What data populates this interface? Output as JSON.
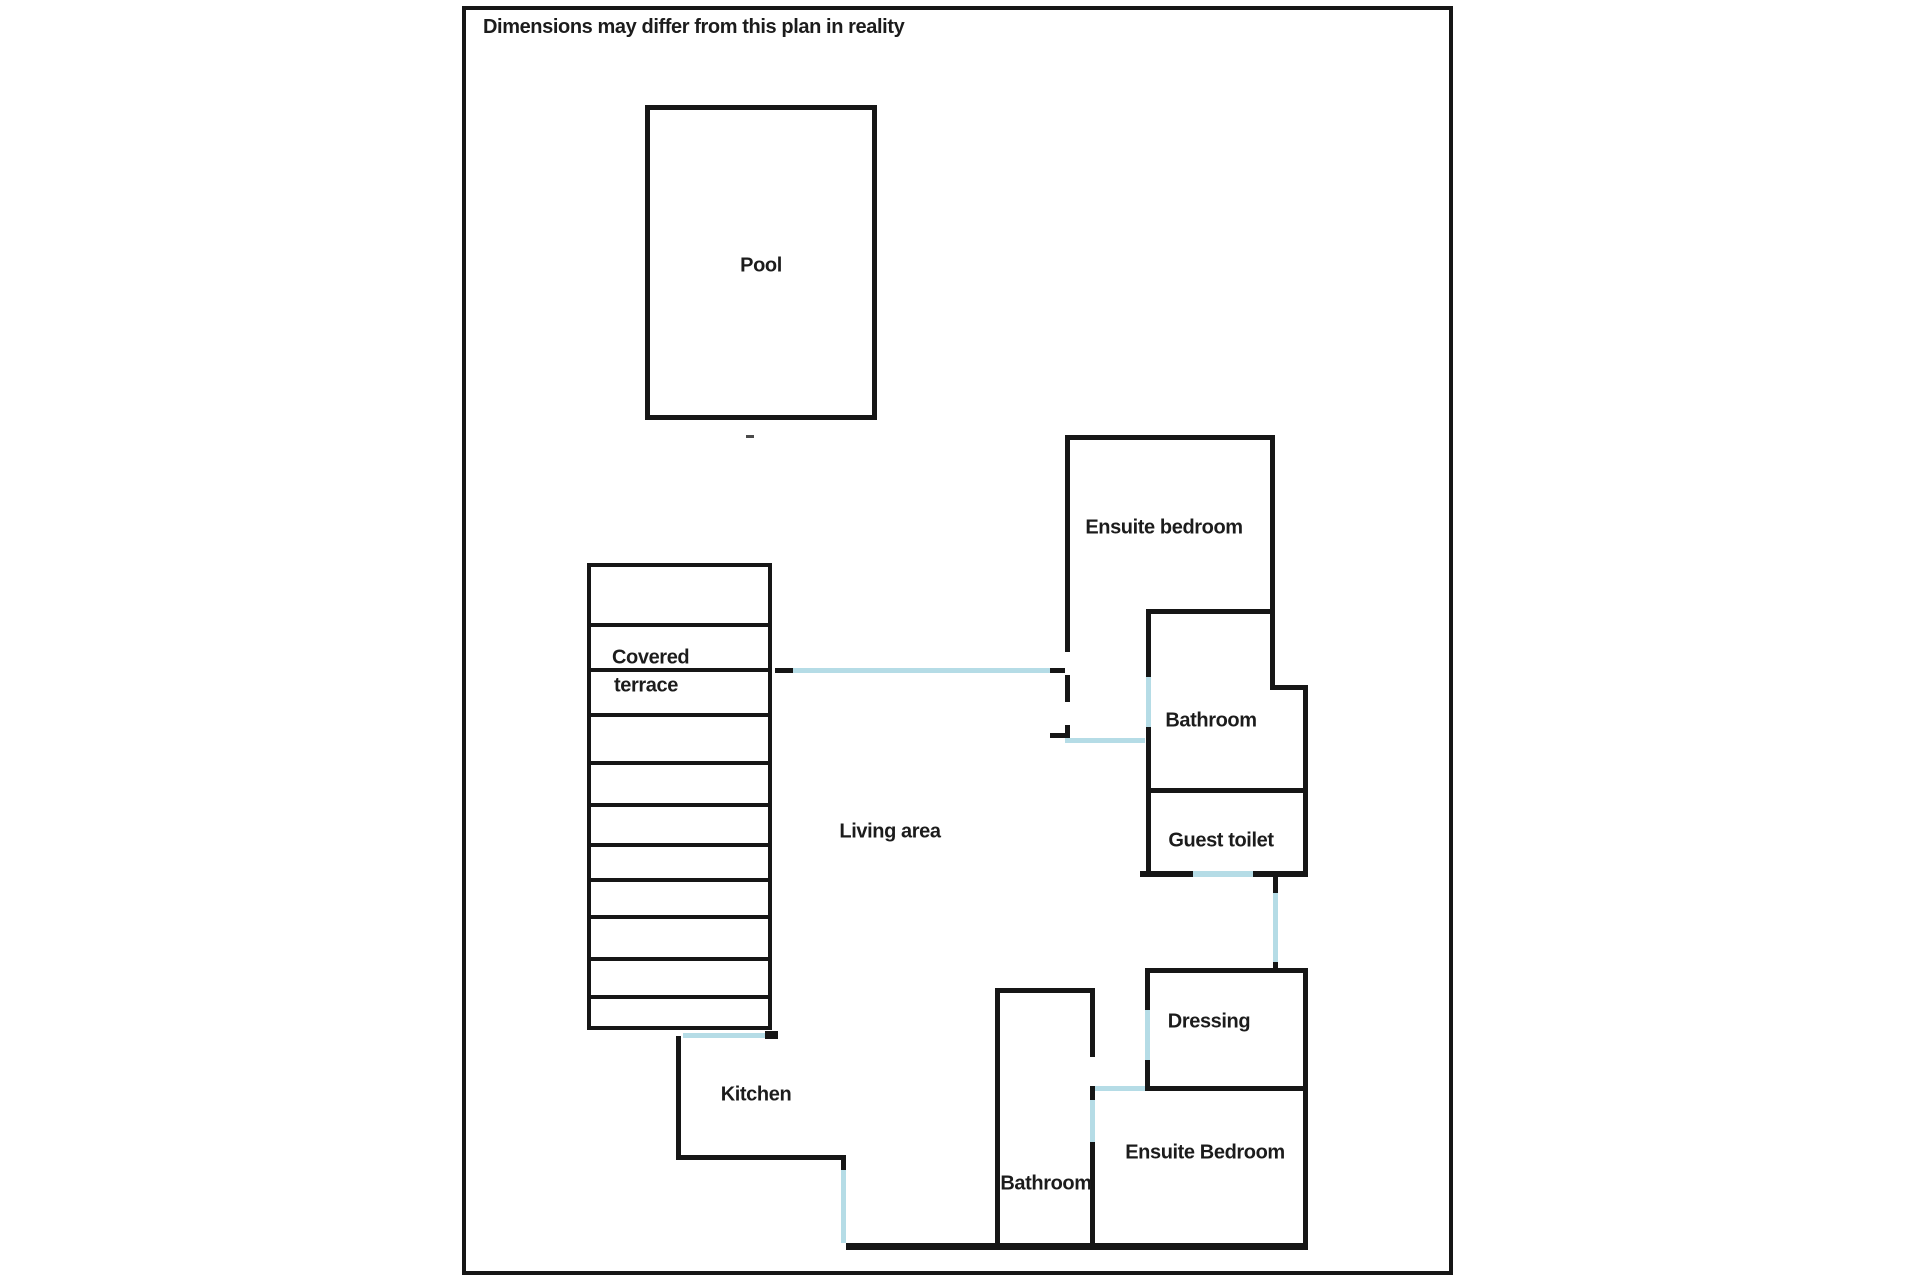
{
  "disclaimer": "Dimensions may differ from this plan in reality",
  "colors": {
    "wall": "#161616",
    "door": "#b5dce6",
    "background": "#ffffff",
    "text": "#1c1c1c",
    "mark": "#4a4a4a"
  },
  "rooms": {
    "pool": {
      "label": "Pool"
    },
    "covered_terrace": {
      "label_line1": "Covered",
      "label_line2": "terrace"
    },
    "living_area": {
      "label": "Living area"
    },
    "ensuite_bedroom_top": {
      "label": "Ensuite bedroom"
    },
    "bathroom_top": {
      "label": "Bathroom"
    },
    "guest_toilet": {
      "label": "Guest toilet"
    },
    "dressing": {
      "label": "Dressing"
    },
    "ensuite_bedroom_bottom": {
      "label": "Ensuite Bedroom"
    },
    "bathroom_bottom": {
      "label": "Bathroom"
    },
    "kitchen": {
      "label": "Kitchen"
    }
  },
  "floorplan": {
    "outlines": [
      {
        "name": "plan-outer-border",
        "x": 462,
        "y": 6,
        "w": 991,
        "h": 1269,
        "stroke": 4
      },
      {
        "name": "pool-outline",
        "x": 645,
        "y": 105,
        "w": 232,
        "h": 315,
        "stroke": 5
      },
      {
        "name": "terrace-outline",
        "x": 587,
        "y": 563,
        "w": 185,
        "h": 467,
        "stroke": 4
      }
    ],
    "walls": [
      {
        "name": "terrace-slat",
        "x": 587,
        "y": 623,
        "w": 185,
        "h": 4
      },
      {
        "name": "terrace-slat",
        "x": 587,
        "y": 668,
        "w": 185,
        "h": 4
      },
      {
        "name": "terrace-slat",
        "x": 587,
        "y": 713,
        "w": 185,
        "h": 4
      },
      {
        "name": "terrace-slat",
        "x": 587,
        "y": 761,
        "w": 185,
        "h": 4
      },
      {
        "name": "terrace-slat",
        "x": 587,
        "y": 803,
        "w": 185,
        "h": 4
      },
      {
        "name": "terrace-slat",
        "x": 587,
        "y": 843,
        "w": 185,
        "h": 4
      },
      {
        "name": "terrace-slat",
        "x": 587,
        "y": 878,
        "w": 185,
        "h": 4
      },
      {
        "name": "terrace-slat",
        "x": 587,
        "y": 915,
        "w": 185,
        "h": 4
      },
      {
        "name": "terrace-slat",
        "x": 587,
        "y": 957,
        "w": 185,
        "h": 4
      },
      {
        "name": "terrace-slat",
        "x": 587,
        "y": 995,
        "w": 185,
        "h": 4
      },
      {
        "name": "living-door-tick-left",
        "x": 775,
        "y": 668,
        "w": 18,
        "h": 5
      },
      {
        "name": "living-door-tick-right",
        "x": 1050,
        "y": 668,
        "w": 15,
        "h": 5
      },
      {
        "name": "ensuite-top-wall-top",
        "x": 1065,
        "y": 435,
        "w": 210,
        "h": 5
      },
      {
        "name": "ensuite-top-wall-left",
        "x": 1065,
        "y": 435,
        "w": 5,
        "h": 217
      },
      {
        "name": "ensuite-top-wall-left",
        "x": 1065,
        "y": 675,
        "w": 5,
        "h": 27
      },
      {
        "name": "ensuite-top-wall-left",
        "x": 1065,
        "y": 725,
        "w": 5,
        "h": 15
      },
      {
        "name": "ensuite-top-wall-tick",
        "x": 1050,
        "y": 733,
        "w": 15,
        "h": 5
      },
      {
        "name": "ensuite-top-wall-right",
        "x": 1270,
        "y": 435,
        "w": 5,
        "h": 255
      },
      {
        "name": "bathroom-top-wall-top",
        "x": 1147,
        "y": 609,
        "w": 128,
        "h": 5
      },
      {
        "name": "bathroom-top-jog",
        "x": 1270,
        "y": 685,
        "w": 38,
        "h": 5
      },
      {
        "name": "right-wing-wall-right",
        "x": 1303,
        "y": 685,
        "w": 5,
        "h": 191
      },
      {
        "name": "bathroom-top-wall-left",
        "x": 1146,
        "y": 609,
        "w": 5,
        "h": 68
      },
      {
        "name": "bathroom-top-wall-left",
        "x": 1146,
        "y": 727,
        "w": 5,
        "h": 64
      },
      {
        "name": "bathroom-top-wall-bottom",
        "x": 1146,
        "y": 788,
        "w": 162,
        "h": 5
      },
      {
        "name": "guest-toilet-wall-left",
        "x": 1146,
        "y": 788,
        "w": 5,
        "h": 88
      },
      {
        "name": "guest-toilet-wall-bottom",
        "x": 1140,
        "y": 871,
        "w": 53,
        "h": 6
      },
      {
        "name": "guest-toilet-wall-bottom",
        "x": 1253,
        "y": 871,
        "w": 55,
        "h": 6
      },
      {
        "name": "hall-connector-tick",
        "x": 1273,
        "y": 876,
        "w": 5,
        "h": 17
      },
      {
        "name": "hall-connector-tick",
        "x": 1273,
        "y": 962,
        "w": 5,
        "h": 8
      },
      {
        "name": "dressing-wall-top",
        "x": 1145,
        "y": 968,
        "w": 163,
        "h": 5
      },
      {
        "name": "dressing-wall-left",
        "x": 1145,
        "y": 968,
        "w": 5,
        "h": 42
      },
      {
        "name": "dressing-wall-left",
        "x": 1145,
        "y": 1060,
        "w": 5,
        "h": 26
      },
      {
        "name": "dressing-wall-bottom",
        "x": 1145,
        "y": 1086,
        "w": 163,
        "h": 5
      },
      {
        "name": "right-wing-wall-right",
        "x": 1303,
        "y": 968,
        "w": 5,
        "h": 279
      },
      {
        "name": "bathroom-bottom-wall-top",
        "x": 995,
        "y": 988,
        "w": 100,
        "h": 5
      },
      {
        "name": "bathroom-bottom-wall-left",
        "x": 995,
        "y": 988,
        "w": 5,
        "h": 259
      },
      {
        "name": "bathroom-bottom-wall-right",
        "x": 1090,
        "y": 988,
        "w": 5,
        "h": 69
      },
      {
        "name": "bathroom-bottom-wall-right",
        "x": 1090,
        "y": 1086,
        "w": 5,
        "h": 14
      },
      {
        "name": "bathroom-bottom-wall-right",
        "x": 1090,
        "y": 1142,
        "w": 5,
        "h": 105
      },
      {
        "name": "kitchen-wall-left",
        "x": 676,
        "y": 1036,
        "w": 5,
        "h": 124
      },
      {
        "name": "kitchen-wall-bottom",
        "x": 676,
        "y": 1155,
        "w": 170,
        "h": 5
      },
      {
        "name": "kitchen-wall-tick",
        "x": 841,
        "y": 1155,
        "w": 5,
        "h": 15
      },
      {
        "name": "bottom-main-wall",
        "x": 846,
        "y": 1243,
        "w": 462,
        "h": 7
      },
      {
        "name": "terrace-door-tick",
        "x": 765,
        "y": 1031,
        "w": 13,
        "h": 8
      }
    ],
    "doors": [
      {
        "name": "living-area-opening",
        "x": 793,
        "y": 668,
        "w": 257,
        "h": 5
      },
      {
        "name": "bathroom-top-door",
        "x": 1146,
        "y": 677,
        "w": 5,
        "h": 50
      },
      {
        "name": "ensuite-top-hall-door",
        "x": 1065,
        "y": 738,
        "w": 80,
        "h": 5
      },
      {
        "name": "guest-toilet-door",
        "x": 1193,
        "y": 871,
        "w": 60,
        "h": 6
      },
      {
        "name": "hall-connector-opening",
        "x": 1273,
        "y": 893,
        "w": 5,
        "h": 69
      },
      {
        "name": "dressing-door",
        "x": 1145,
        "y": 1010,
        "w": 5,
        "h": 50
      },
      {
        "name": "ensuite-bottom-door",
        "x": 1095,
        "y": 1086,
        "w": 50,
        "h": 5
      },
      {
        "name": "bathroom-bottom-door",
        "x": 1090,
        "y": 1100,
        "w": 5,
        "h": 42
      },
      {
        "name": "kitchen-hall-opening",
        "x": 841,
        "y": 1170,
        "w": 5,
        "h": 73
      },
      {
        "name": "terrace-kitchen-door",
        "x": 683,
        "y": 1033,
        "w": 82,
        "h": 5
      }
    ],
    "marks": [
      {
        "name": "small-dash-mark",
        "x": 746,
        "y": 435,
        "w": 8,
        "h": 3
      }
    ]
  }
}
